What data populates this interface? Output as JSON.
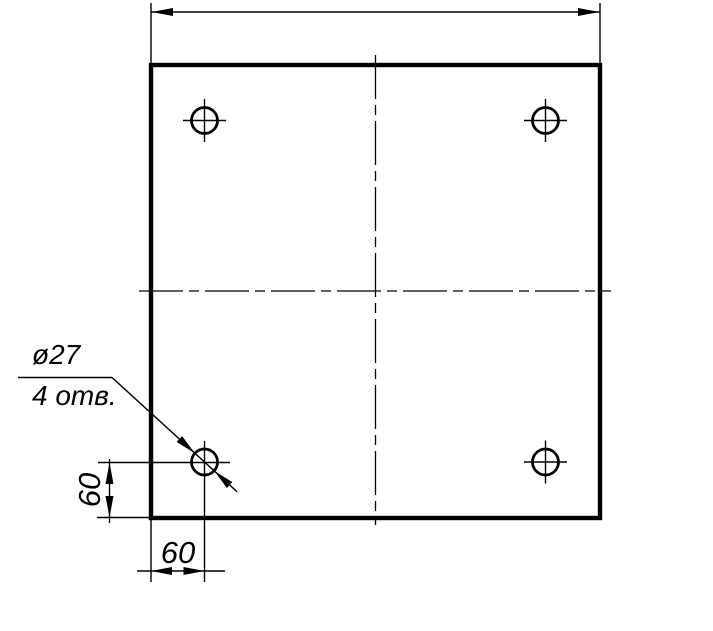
{
  "drawing": {
    "kind": "technical-drawing-plate-with-holes",
    "background_color": "#ffffff",
    "line_color": "#000000",
    "callout": {
      "diameter_label": "ø27",
      "count_label": "4 отв."
    },
    "dimensions": {
      "left_value": "60",
      "bottom_value": "60",
      "top_value": ""
    }
  }
}
